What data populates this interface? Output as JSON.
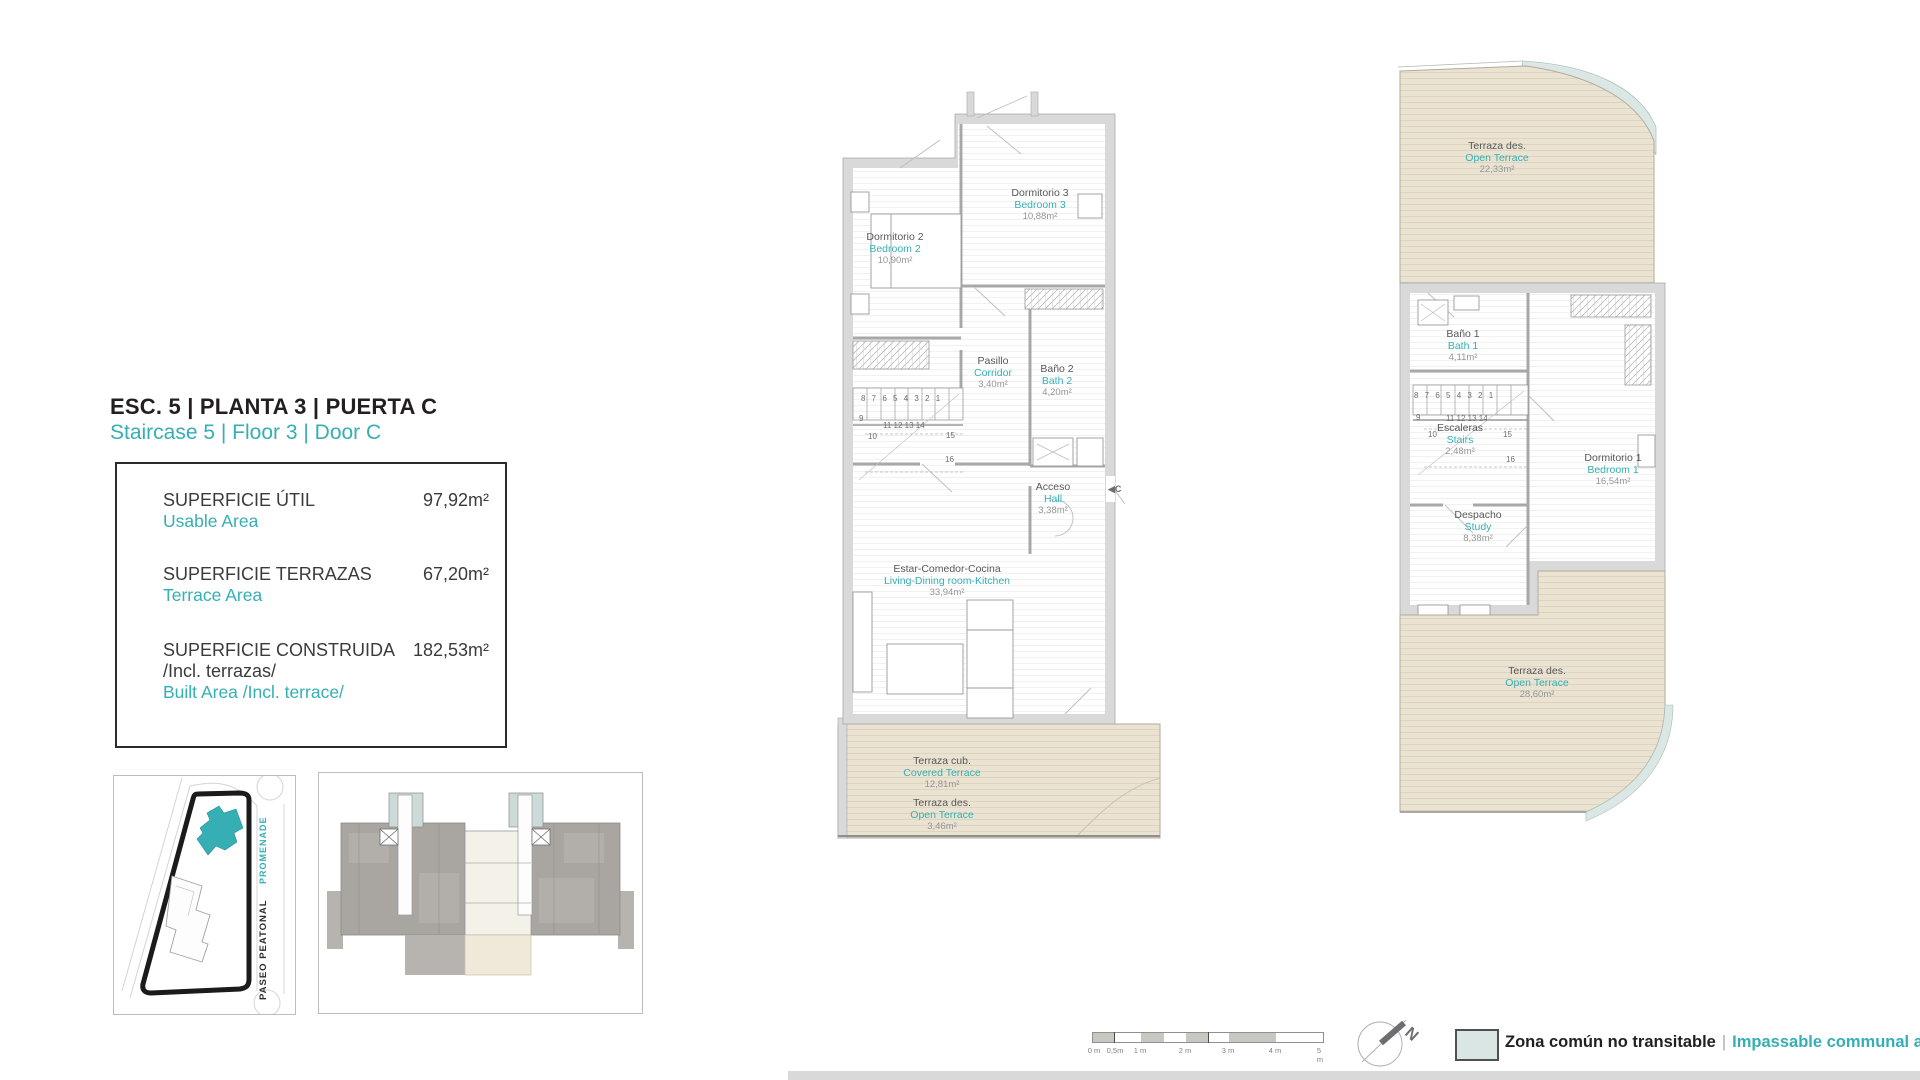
{
  "colors": {
    "teal": "#35afb4",
    "communal_fill": "#dbe7e5",
    "terrace_fill": "#eae3d2",
    "wall_fill": "#d9d9d9"
  },
  "header": {
    "title_es": "ESC. 5 | PLANTA 3 | PUERTA C",
    "title_en": "Staircase 5 | Floor 3 | Door C"
  },
  "areas_box": {
    "usable": {
      "label_es": "SUPERFICIE ÚTIL",
      "label_en": "Usable Area",
      "value": "97,92m²"
    },
    "terraces": {
      "label_es": "SUPERFICIE TERRAZAS",
      "label_en": "Terrace Area",
      "value": "67,20m²"
    },
    "built": {
      "label_es": "SUPERFICIE CONSTRUIDA",
      "label_es_line2": "/Incl. terrazas/",
      "label_en": "Built Area /Incl. terrace/",
      "value": "182,53m²"
    }
  },
  "site_plan": {
    "street_primary": "PASEO PEATONAL",
    "street_secondary": "PROMENADE"
  },
  "plan_lower": {
    "rooms": {
      "bedroom2": {
        "es": "Dormitorio 2",
        "en": "Bedroom 2",
        "area": "10,90m²"
      },
      "bedroom3": {
        "es": "Dormitorio 3",
        "en": "Bedroom 3",
        "area": "10,88m²"
      },
      "corridor": {
        "es": "Pasillo",
        "en": "Corridor",
        "area": "3,40m²"
      },
      "bath2": {
        "es": "Baño 2",
        "en": "Bath 2",
        "area": "4,20m²"
      },
      "hall": {
        "es": "Acceso",
        "en": "Hall",
        "area": "3,38m²"
      },
      "living": {
        "es": "Estar-Comedor-Cocina",
        "en": "Living-Dining room-Kitchen",
        "area": "33,94m²"
      },
      "covered_terrace": {
        "es": "Terraza cub.",
        "en": "Covered Terrace",
        "area": "12,81m²"
      },
      "open_terrace": {
        "es": "Terraza des.",
        "en": "Open Terrace",
        "area": "3,46m²"
      }
    },
    "stairs": {
      "top_row": "8 7 6 5 4 3 2 1",
      "n9": "9",
      "n10": "10",
      "mid_row": "11 12 13 14",
      "n15": "15",
      "n16": "16"
    },
    "door_marker": "◀C"
  },
  "plan_upper": {
    "rooms": {
      "open_terrace_top": {
        "es": "Terraza des.",
        "en": "Open Terrace",
        "area": "22,33m²"
      },
      "bath1": {
        "es": "Baño 1",
        "en": "Bath 1",
        "area": "4,11m²"
      },
      "stairs": {
        "es": "Escaleras",
        "en": "Stairs",
        "area": "2,48m²"
      },
      "bedroom1": {
        "es": "Dormitorio 1",
        "en": "Bedroom 1",
        "area": "16,54m²"
      },
      "study": {
        "es": "Despacho",
        "en": "Study",
        "area": "8,38m²"
      },
      "open_terrace_bottom": {
        "es": "Terraza des.",
        "en": "Open Terrace",
        "area": "28,60m²"
      }
    },
    "stairs_numbers": {
      "top_row": "8 7 6 5 4 3 2 1",
      "n9": "9",
      "n10": "10",
      "mid_row": "11 12 13 14",
      "n15": "15",
      "n16": "16"
    }
  },
  "scale_bar": {
    "labels": [
      "0 m",
      "0,5m",
      "1 m",
      "2 m",
      "3 m",
      "4 m",
      "5 m"
    ]
  },
  "north": {
    "label": "N"
  },
  "legend": {
    "label_es": "Zona común no transitable",
    "separator": "|",
    "label_en": "Impassable communal area"
  }
}
